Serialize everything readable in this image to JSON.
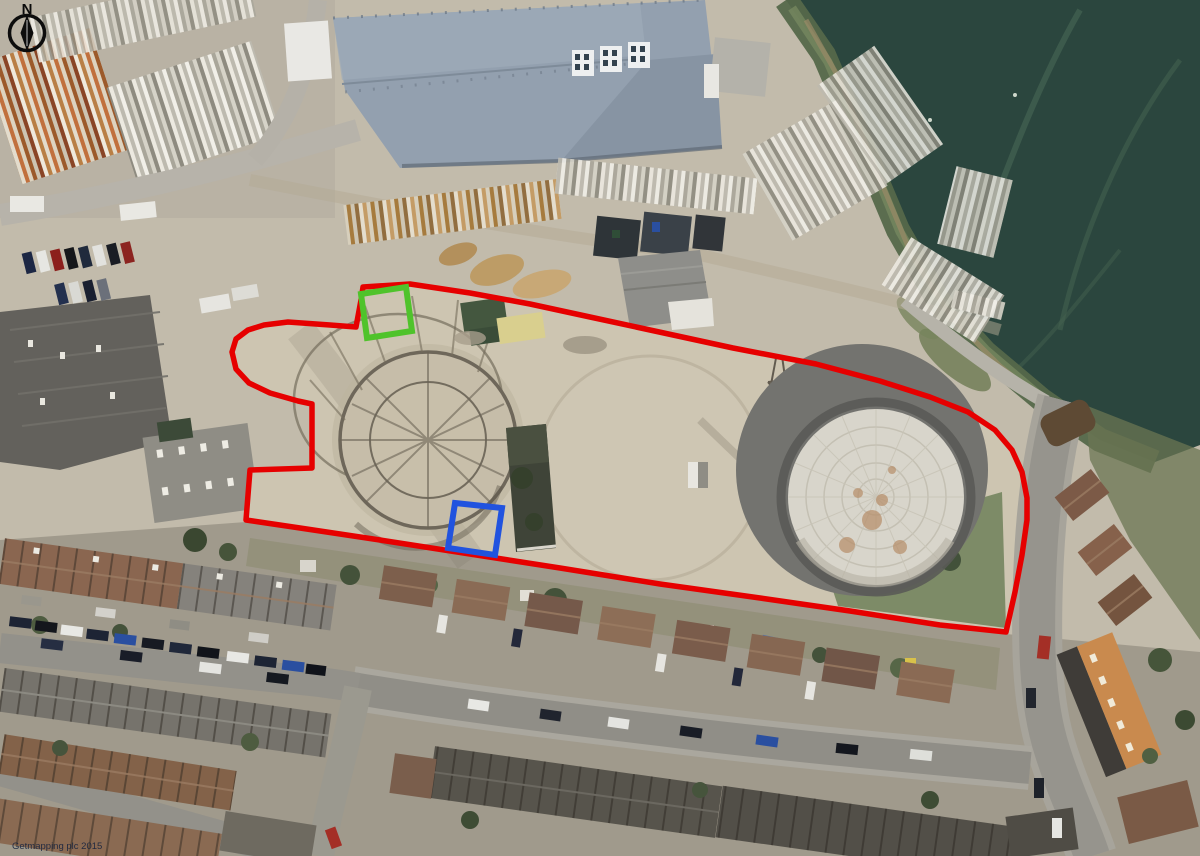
{
  "map": {
    "compass_label": "N",
    "copyright": "Getmapping plc 2015"
  },
  "annotations": {
    "boundary_color": "#e60000",
    "green_marker_color": "#4fc32b",
    "blue_marker_color": "#2153df"
  }
}
